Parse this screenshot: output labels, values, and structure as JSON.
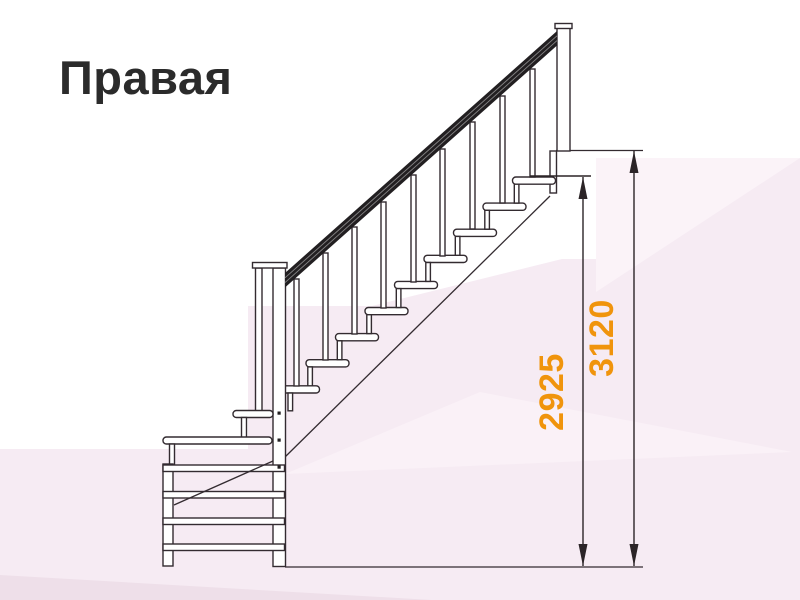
{
  "title": "Правая",
  "drawing": {
    "name": "staircase-side-elevation",
    "dimensions": [
      {
        "id": "stair-height",
        "value": "2925"
      },
      {
        "id": "total-height",
        "value": "3120"
      }
    ]
  },
  "colors": {
    "title": "#2B2B2B",
    "dimension_label": "#F0940C",
    "outline": "#332B30",
    "handrail": "#221F21",
    "background": "#FFFFFF",
    "bg_pink": "#F6EBF3",
    "bg_pink_light": "#FBF3F8",
    "bg_pink_lighter": "#FAF1F7",
    "bg_pink_deep": "#EEDFE9"
  }
}
